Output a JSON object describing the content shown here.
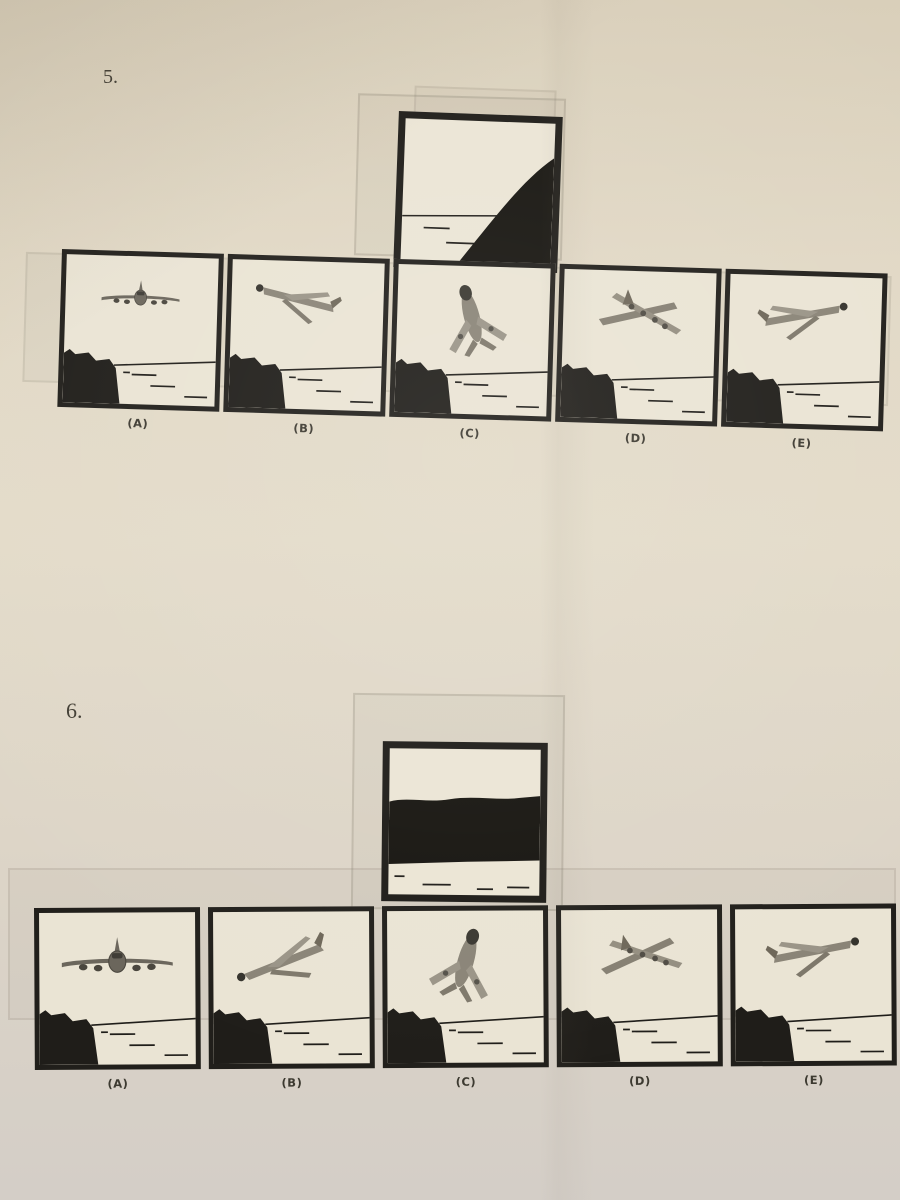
{
  "doc": {
    "questions": [
      {
        "number": "5.",
        "stimulus_icon": "cockpit-view-coastline-hill-right-icon",
        "options": [
          {
            "label": "(A)",
            "icon": "plane-front-level-icon"
          },
          {
            "label": "(B)",
            "icon": "plane-rear-descending-left-icon"
          },
          {
            "label": "(C)",
            "icon": "plane-climbing-toward-upper-left-icon"
          },
          {
            "label": "(D)",
            "icon": "plane-rear-banked-right-icon"
          },
          {
            "label": "(E)",
            "icon": "plane-rear-climbing-upper-right-icon"
          }
        ]
      },
      {
        "number": "6.",
        "stimulus_icon": "cockpit-view-mountain-ridge-icon",
        "options": [
          {
            "label": "(A)",
            "icon": "plane-front-level-icon"
          },
          {
            "label": "(B)",
            "icon": "plane-rear-climbing-right-nose-left-icon"
          },
          {
            "label": "(C)",
            "icon": "plane-climbing-toward-upper-right-icon"
          },
          {
            "label": "(D)",
            "icon": "plane-rear-banked-right-icon"
          },
          {
            "label": "(E)",
            "icon": "plane-rear-climbing-upper-right-icon"
          }
        ]
      }
    ],
    "colors": {
      "paper": "#e1d8c5",
      "ink": "#211f1b",
      "plane_gray": "#87816f"
    }
  }
}
